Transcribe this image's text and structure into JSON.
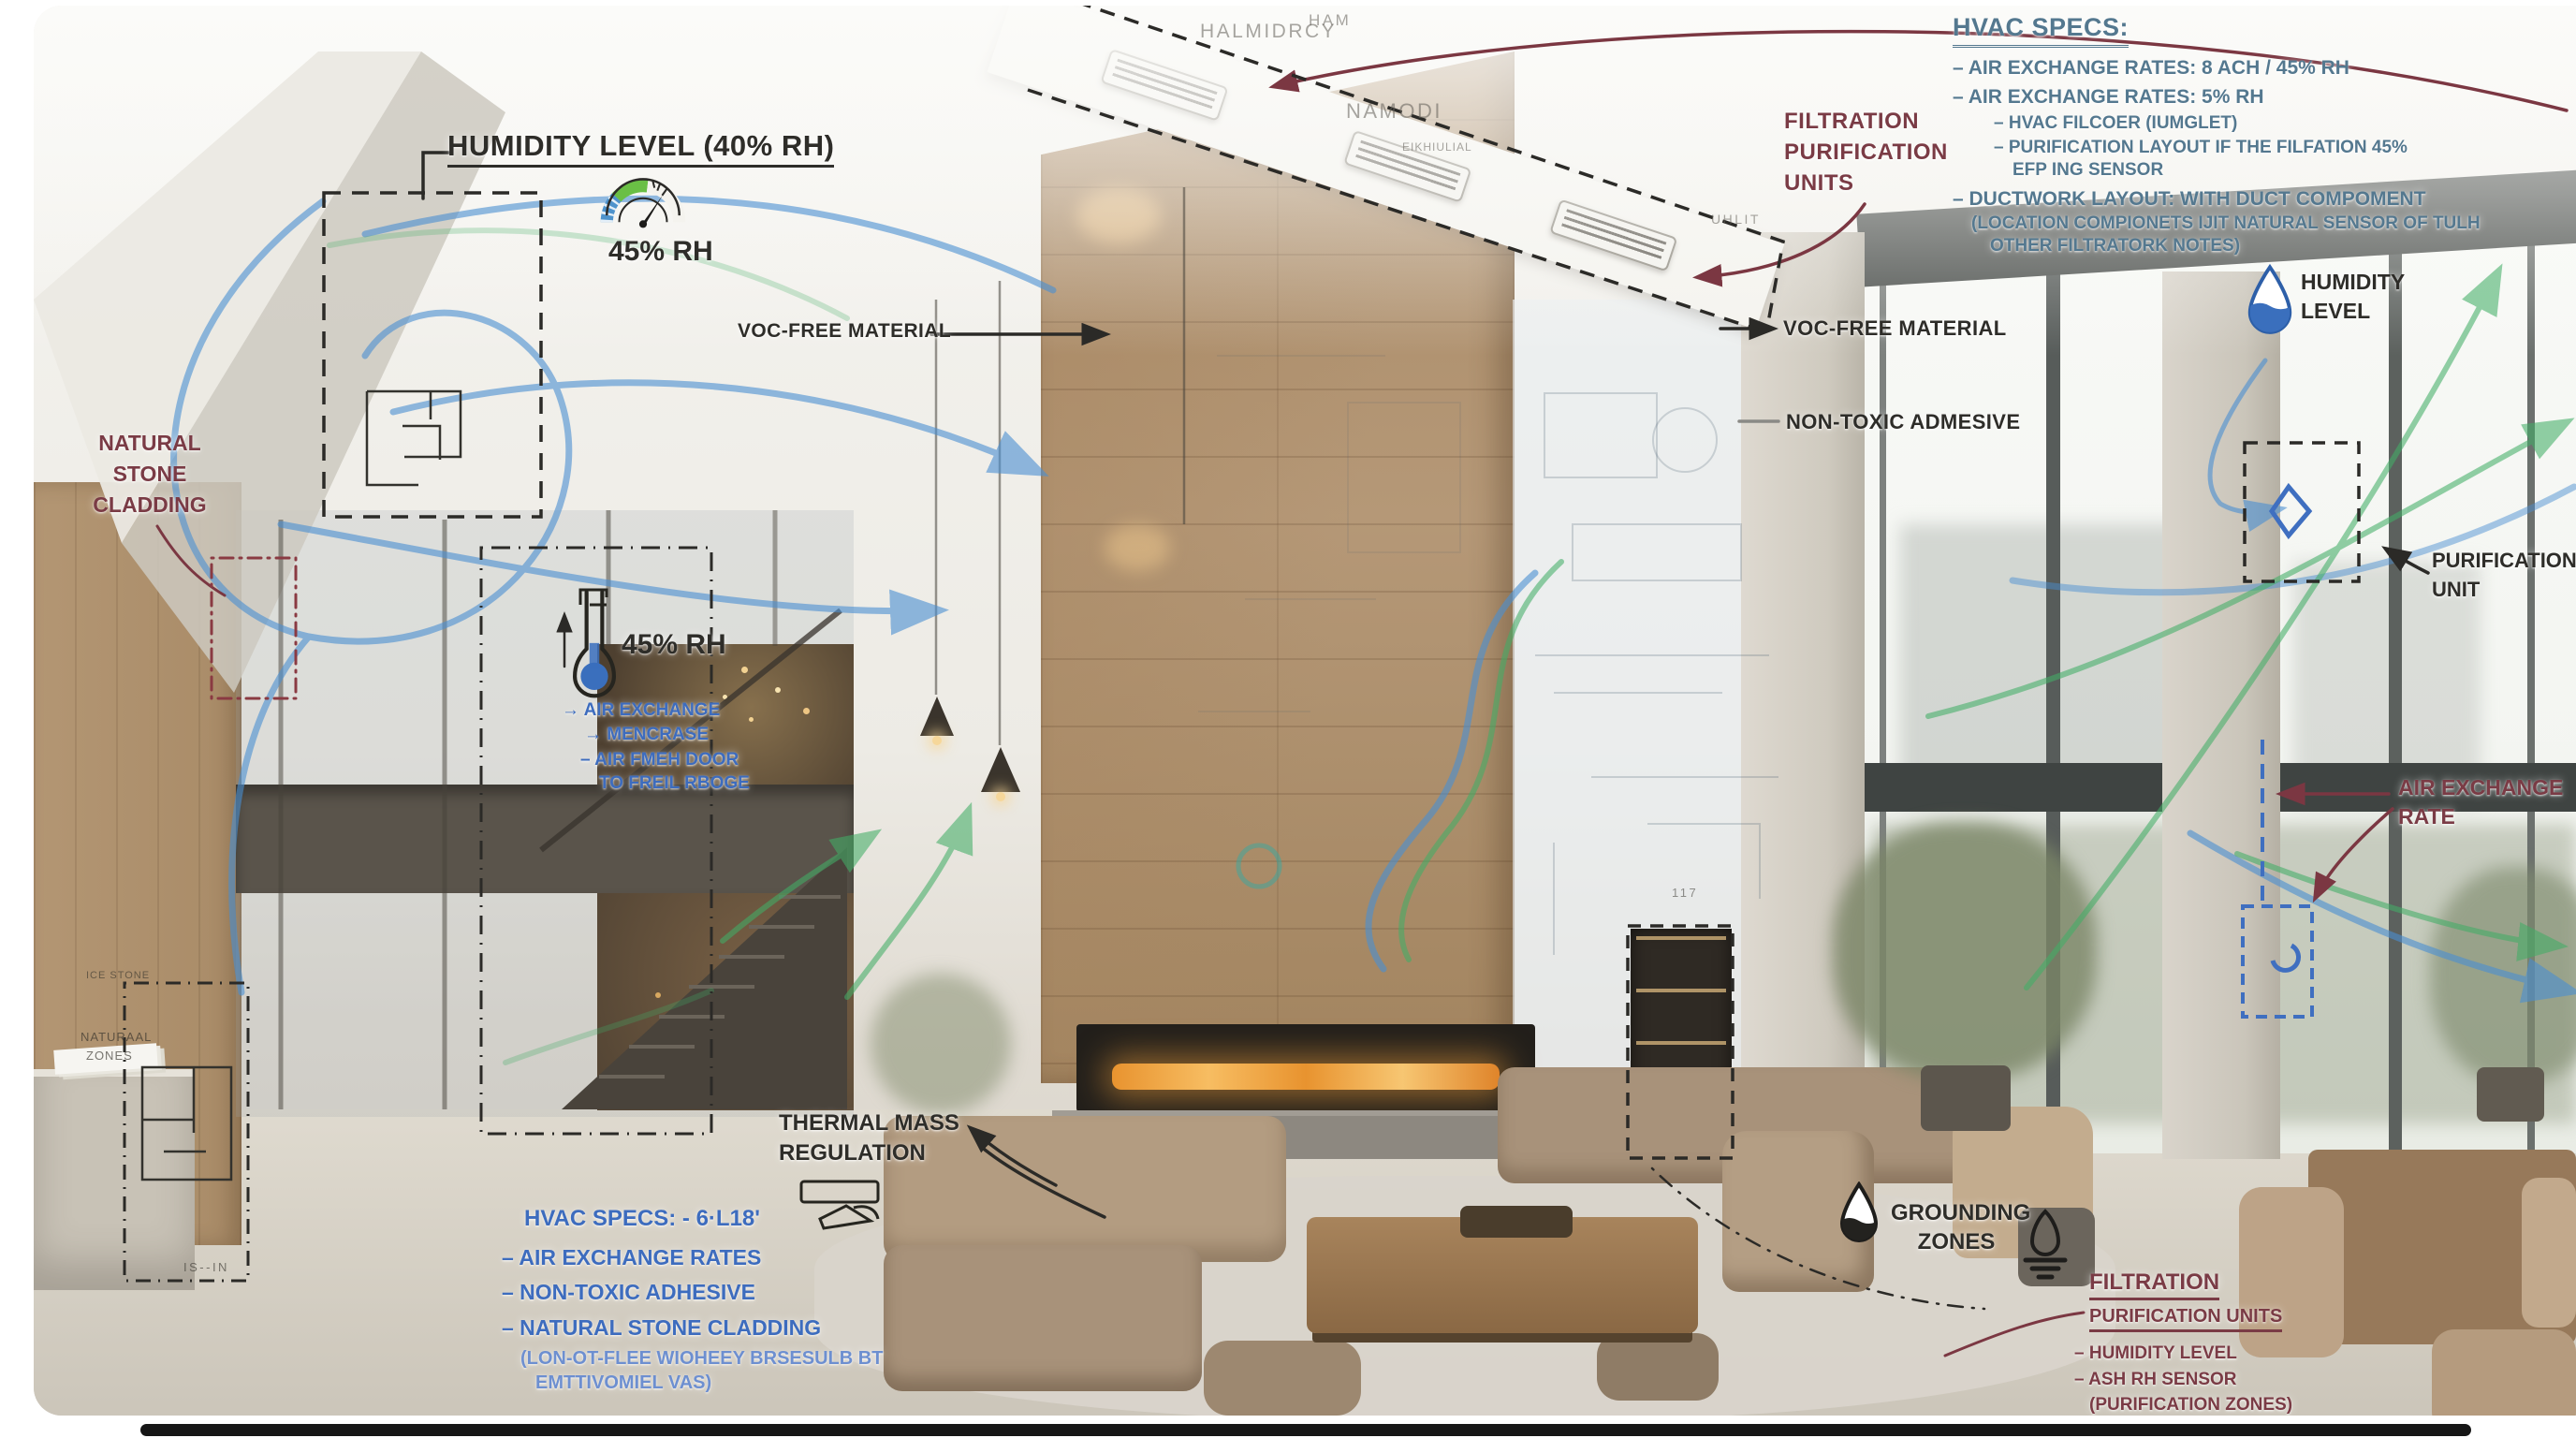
{
  "annotations": {
    "humidity_gauge": {
      "title": "HUMIDITY LEVEL",
      "suffix": "(40% RH)",
      "value": "45% RH"
    },
    "hvac_top": {
      "title": "HVAC SPECS:",
      "items": [
        "– AIR EXCHANGE RATES: 8 ACH / 45% RH",
        "– AIR EXCHANGE RATES: 5% RH",
        "– HVAC FILCOER (IUMGLET)",
        "– PURIFICATION LAYOUT IF THE FILFATION 45%",
        "EFP ING SENSOR",
        "– DUCTWORK LAYOUT: WITH DUCT COMPOMENT",
        "(LOCATION COMPIONETS IJIT NATURAL SENSOR OF TULH",
        "OTHER FILTRATORK NOTES)"
      ]
    },
    "filtration_top": {
      "l1": "FILTRATION",
      "l2": "PURIFICATION",
      "l3": "UNITS"
    },
    "voc_left": "VOC-FREE MATERIAL",
    "voc_right": "VOC-FREE MATERIAL",
    "non_toxic": "NON-TOXIC ADMESIVE",
    "natural_stone": {
      "l1": "NATURAL",
      "l2": "STONE",
      "l3": "CLADDING"
    },
    "humidity_right": {
      "l1": "HUMIDITY",
      "l2": "LEVEL"
    },
    "purification_unit": {
      "l1": "PURIFICATION",
      "l2": "UNIT"
    },
    "air_exchange_rate": {
      "l1": "AIR EXCHANGE",
      "l2": "RATE"
    },
    "flask": {
      "value": "45% RH",
      "notes": [
        "→ AIR EXCHANGE",
        "→ MENCRASE",
        "– AIR FMEH DOOR",
        "TO FREIL RBOGE"
      ]
    },
    "thermal_mass": {
      "l1": "THERMAL MASS",
      "l2": "REGULATION"
    },
    "hvac_bottom": {
      "title": "HVAC SPECS: - 6·L18'",
      "items": [
        "– AIR EXCHANGE RATES",
        "– NON-TOXIC ADHESIVE",
        "– NATURAL STONE CLADDING"
      ],
      "note1": "(LON-OT-FLEE WIOHEEY BRSESULB BT",
      "note2": "EMTTIVOMIEL VAS)"
    },
    "grounding": {
      "l1": "GROUNDING",
      "l2": "ZONES"
    },
    "filtration_bottom": {
      "t1": "FILTRATION",
      "t2": "PURIFICATION UNITS",
      "items": [
        "– HUMIDITY LEVEL",
        "– ASH RH SENSOR",
        "(PURIFICATION ZONES)"
      ]
    }
  },
  "scene": {
    "faint_labels": {
      "halmidrcy": "HALMIDRCY",
      "ham": "HAM",
      "namodi": "NAMODI",
      "eikh": "EIKHIULIAL",
      "uhlit": "UHLIT",
      "n117": "117",
      "ice_stone": "ICE STONE",
      "naturaal": "NATURAAL",
      "zones": "ZONES",
      "is_in": "IS--IN"
    }
  },
  "colors": {
    "flow_blue": "#4a8fd2",
    "flow_green": "#43ad67",
    "ink_black": "#2b2a27",
    "ink_red": "#7b3742",
    "ink_blue": "#3d6cbe",
    "ink_steel": "#54788f"
  }
}
